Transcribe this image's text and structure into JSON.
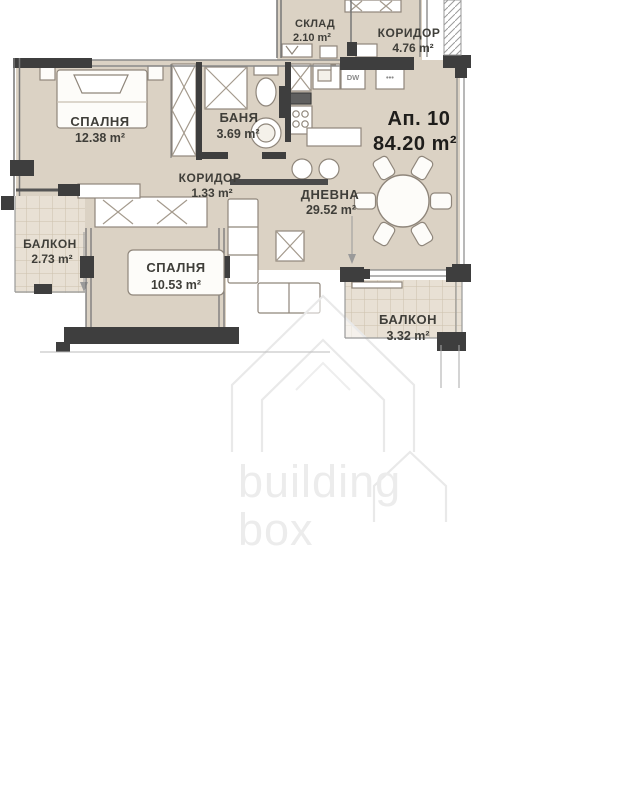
{
  "apartment": {
    "number_label": "Ап. 10",
    "area_label": "84.20 m²"
  },
  "rooms": [
    {
      "id": "storage",
      "name": "СКЛАД",
      "area": "2.10 m²"
    },
    {
      "id": "corridor-top",
      "name": "КОРИДОР",
      "area": "4.76 m²"
    },
    {
      "id": "bedroom-1",
      "name": "СПАЛНЯ",
      "area": "12.38 m²"
    },
    {
      "id": "bathroom",
      "name": "БАНЯ",
      "area": "3.69 m²"
    },
    {
      "id": "corridor",
      "name": "КОРИДОР",
      "area": "1.33 m²"
    },
    {
      "id": "living-room",
      "name": "ДНЕВНА",
      "area": "29.52 m²"
    },
    {
      "id": "balcony-left",
      "name": "БАЛКОН",
      "area": "2.73 m²"
    },
    {
      "id": "bedroom-2",
      "name": "СПАЛНЯ",
      "area": "10.53 m²"
    },
    {
      "id": "balcony-right",
      "name": "БАЛКОН",
      "area": "3.32 m²"
    }
  ],
  "appliances": {
    "dishwasher": "DW",
    "hob_dots": "•••"
  },
  "watermark": {
    "line1": "building",
    "line2": "box"
  },
  "colors": {
    "floor": "#dbd2c4",
    "balcony_floor": "#e8e0d4",
    "wall": "#3e3e3e",
    "label_text": "#3f3e39",
    "watermark": "#ececec"
  }
}
